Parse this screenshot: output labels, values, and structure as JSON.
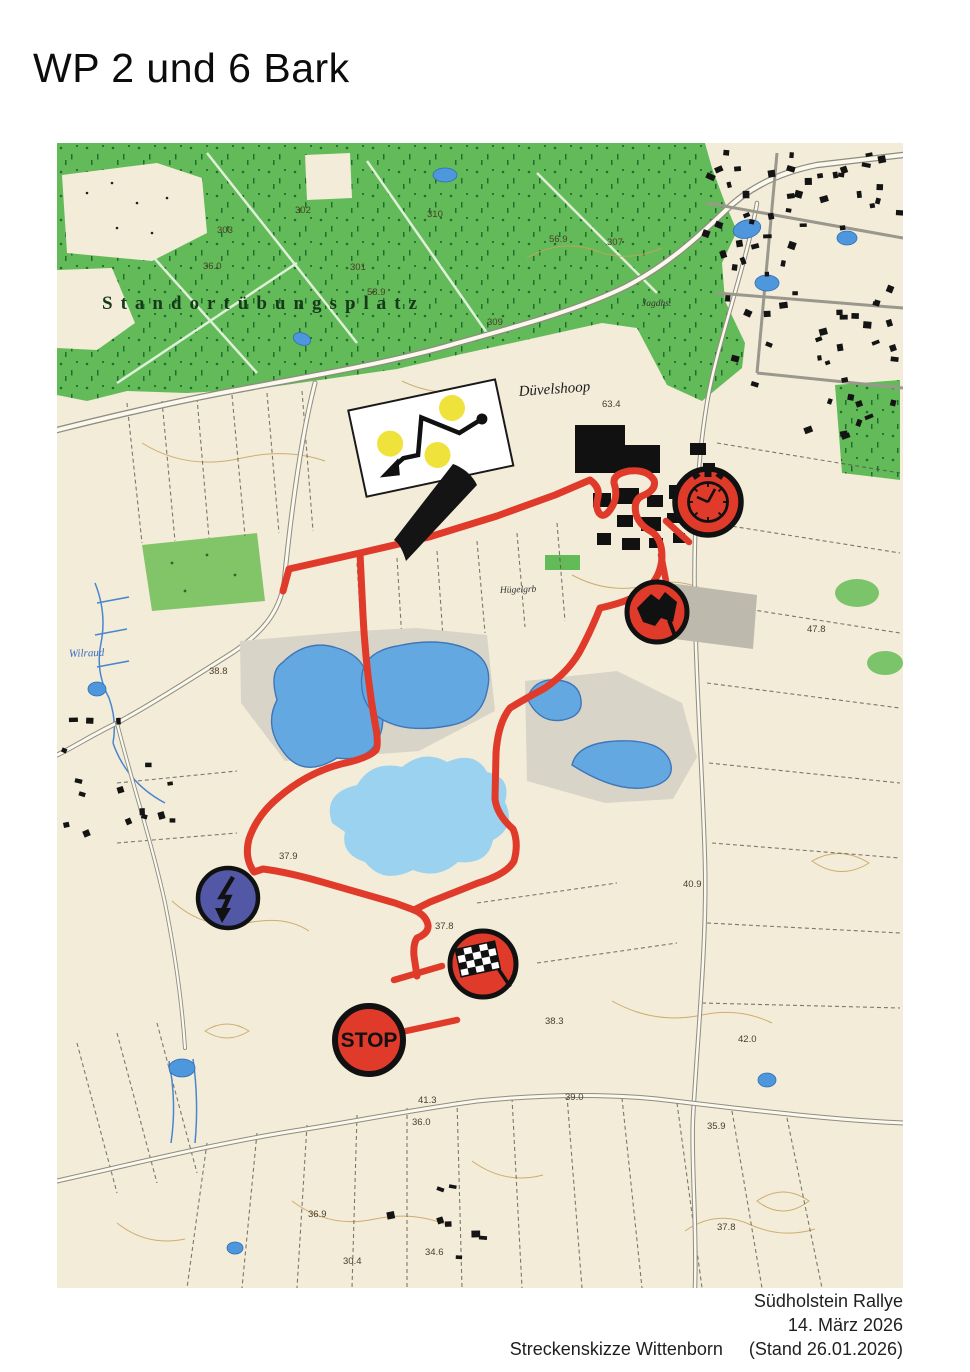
{
  "page": {
    "title": "WP 2 und 6 Bark"
  },
  "footer": {
    "event": "Südholstein Rallye",
    "date": "14. März 2026",
    "sketch_label": "Streckenskizze Wittenborn",
    "revision": "(Stand 26.01.2026)"
  },
  "map": {
    "place_labels": [
      {
        "text": "Standortübungsplatz"
      },
      {
        "text": "B 206"
      },
      {
        "text": "Düvelshoop"
      },
      {
        "text": "Jagdhs."
      },
      {
        "text": "Hügelgrb"
      },
      {
        "text": "Wilraud"
      }
    ],
    "elevations": [
      "303",
      "302",
      "301",
      "310",
      "307",
      "309",
      "56.9",
      "36.0",
      "58.9",
      "63.4",
      "47.8",
      "38.8",
      "37.9",
      "40.9",
      "37.8",
      "38.3",
      "42.0",
      "39.0",
      "41.3",
      "36.0",
      "35.9",
      "37.8",
      "36.9",
      "34.6",
      "30.4"
    ],
    "controls": {
      "time_control": {
        "icon": "stopwatch-icon",
        "circle": "red"
      },
      "start_flag": {
        "icon": "black-flag-icon",
        "circle": "red"
      },
      "flying_finish": {
        "icon": "checkered-flag-icon",
        "circle": "red"
      },
      "stop": {
        "icon": "stop-sign",
        "circle": "red",
        "label": "STOP"
      },
      "radio_point": {
        "icon": "lightning-icon",
        "circle": "blue"
      }
    },
    "chicane_board": {
      "description": "white board: three yellow dots, black route line with start dot and exit arrow"
    },
    "colors": {
      "route": "#e03a2a",
      "forest": "#63ba58",
      "lake": "#64a8e2",
      "lake_shallow": "#9ad2f0",
      "control_red": "#e03a2a",
      "control_blue": "#5257a6",
      "sign_yellow": "#efe23a"
    }
  }
}
